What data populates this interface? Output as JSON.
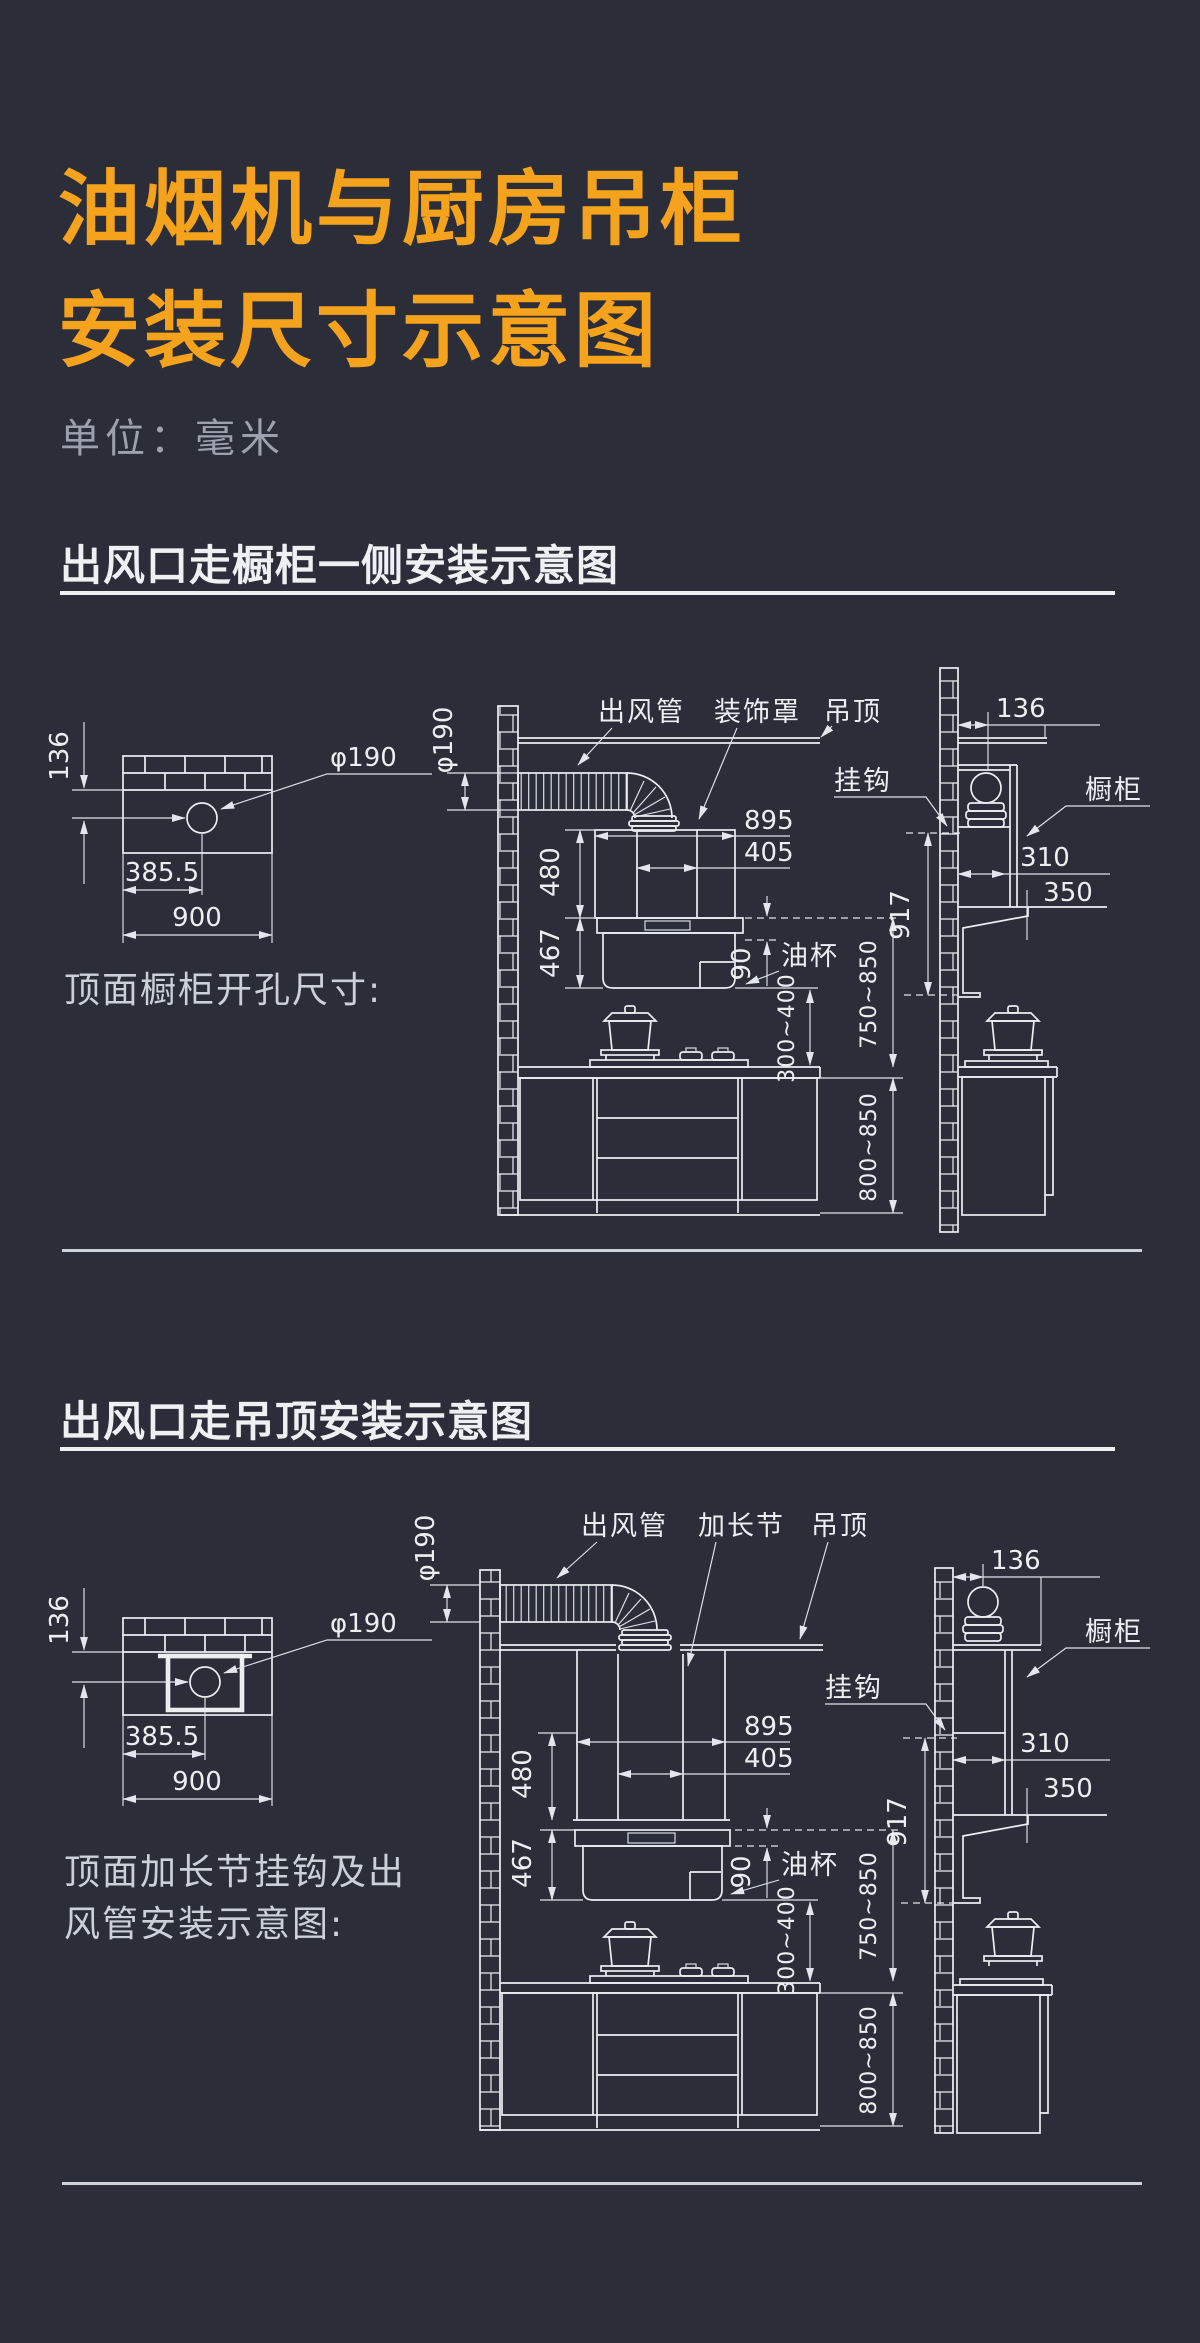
{
  "theme": {
    "background": "#2b2d39",
    "title_orange": "#f5a31d",
    "line_color": "#eceef2",
    "muted_text": "#9ca1ad"
  },
  "header": {
    "title_line1": "油烟机与厨房吊柜",
    "title_line2": "安装尺寸示意图",
    "unit_label": "单位：毫米"
  },
  "sections": {
    "s1": {
      "heading": "出风口走橱柜一侧安装示意图",
      "caption": "顶面橱柜开孔尺寸:",
      "labels": {
        "duct": "出风管",
        "decor_cover": "装饰罩",
        "ceiling": "吊顶",
        "hook": "挂钩",
        "cabinet": "橱柜",
        "oil_cup": "油杯"
      },
      "dims": {
        "wall_to_hole": "136",
        "hole_dia": "φ190",
        "hole_offset": "385.5",
        "cabinet_width": "900",
        "duct_dia": "φ190",
        "hood_width": "895",
        "flue_width": "405",
        "upper_height": "480",
        "body_height": "467",
        "oil_cup_height": "90",
        "hob_clearance": "300~400",
        "hood_clearance": "750~850",
        "counter_height": "800~850",
        "hook_height": "917",
        "side_offset": "136",
        "cabinet_depth": "310",
        "hood_depth": "350"
      }
    },
    "s2": {
      "heading": "出风口走吊顶安装示意图",
      "caption_line1": "顶面加长节挂钩及出",
      "caption_line2": "风管安装示意图:",
      "labels": {
        "duct": "出风管",
        "extension": "加长节",
        "ceiling": "吊顶",
        "hook": "挂钩",
        "cabinet": "橱柜",
        "oil_cup": "油杯"
      },
      "dims": {
        "wall_to_hole": "136",
        "hole_dia": "φ190",
        "hole_offset": "385.5",
        "cabinet_width": "900",
        "duct_dia": "φ190",
        "hood_width": "895",
        "flue_width": "405",
        "upper_height": "480",
        "body_height": "467",
        "oil_cup_height": "90",
        "hob_clearance": "300~400",
        "hood_clearance": "750~850",
        "counter_height": "800~850",
        "hook_height": "917",
        "side_offset": "136",
        "cabinet_depth": "310",
        "hood_depth": "350"
      }
    }
  }
}
